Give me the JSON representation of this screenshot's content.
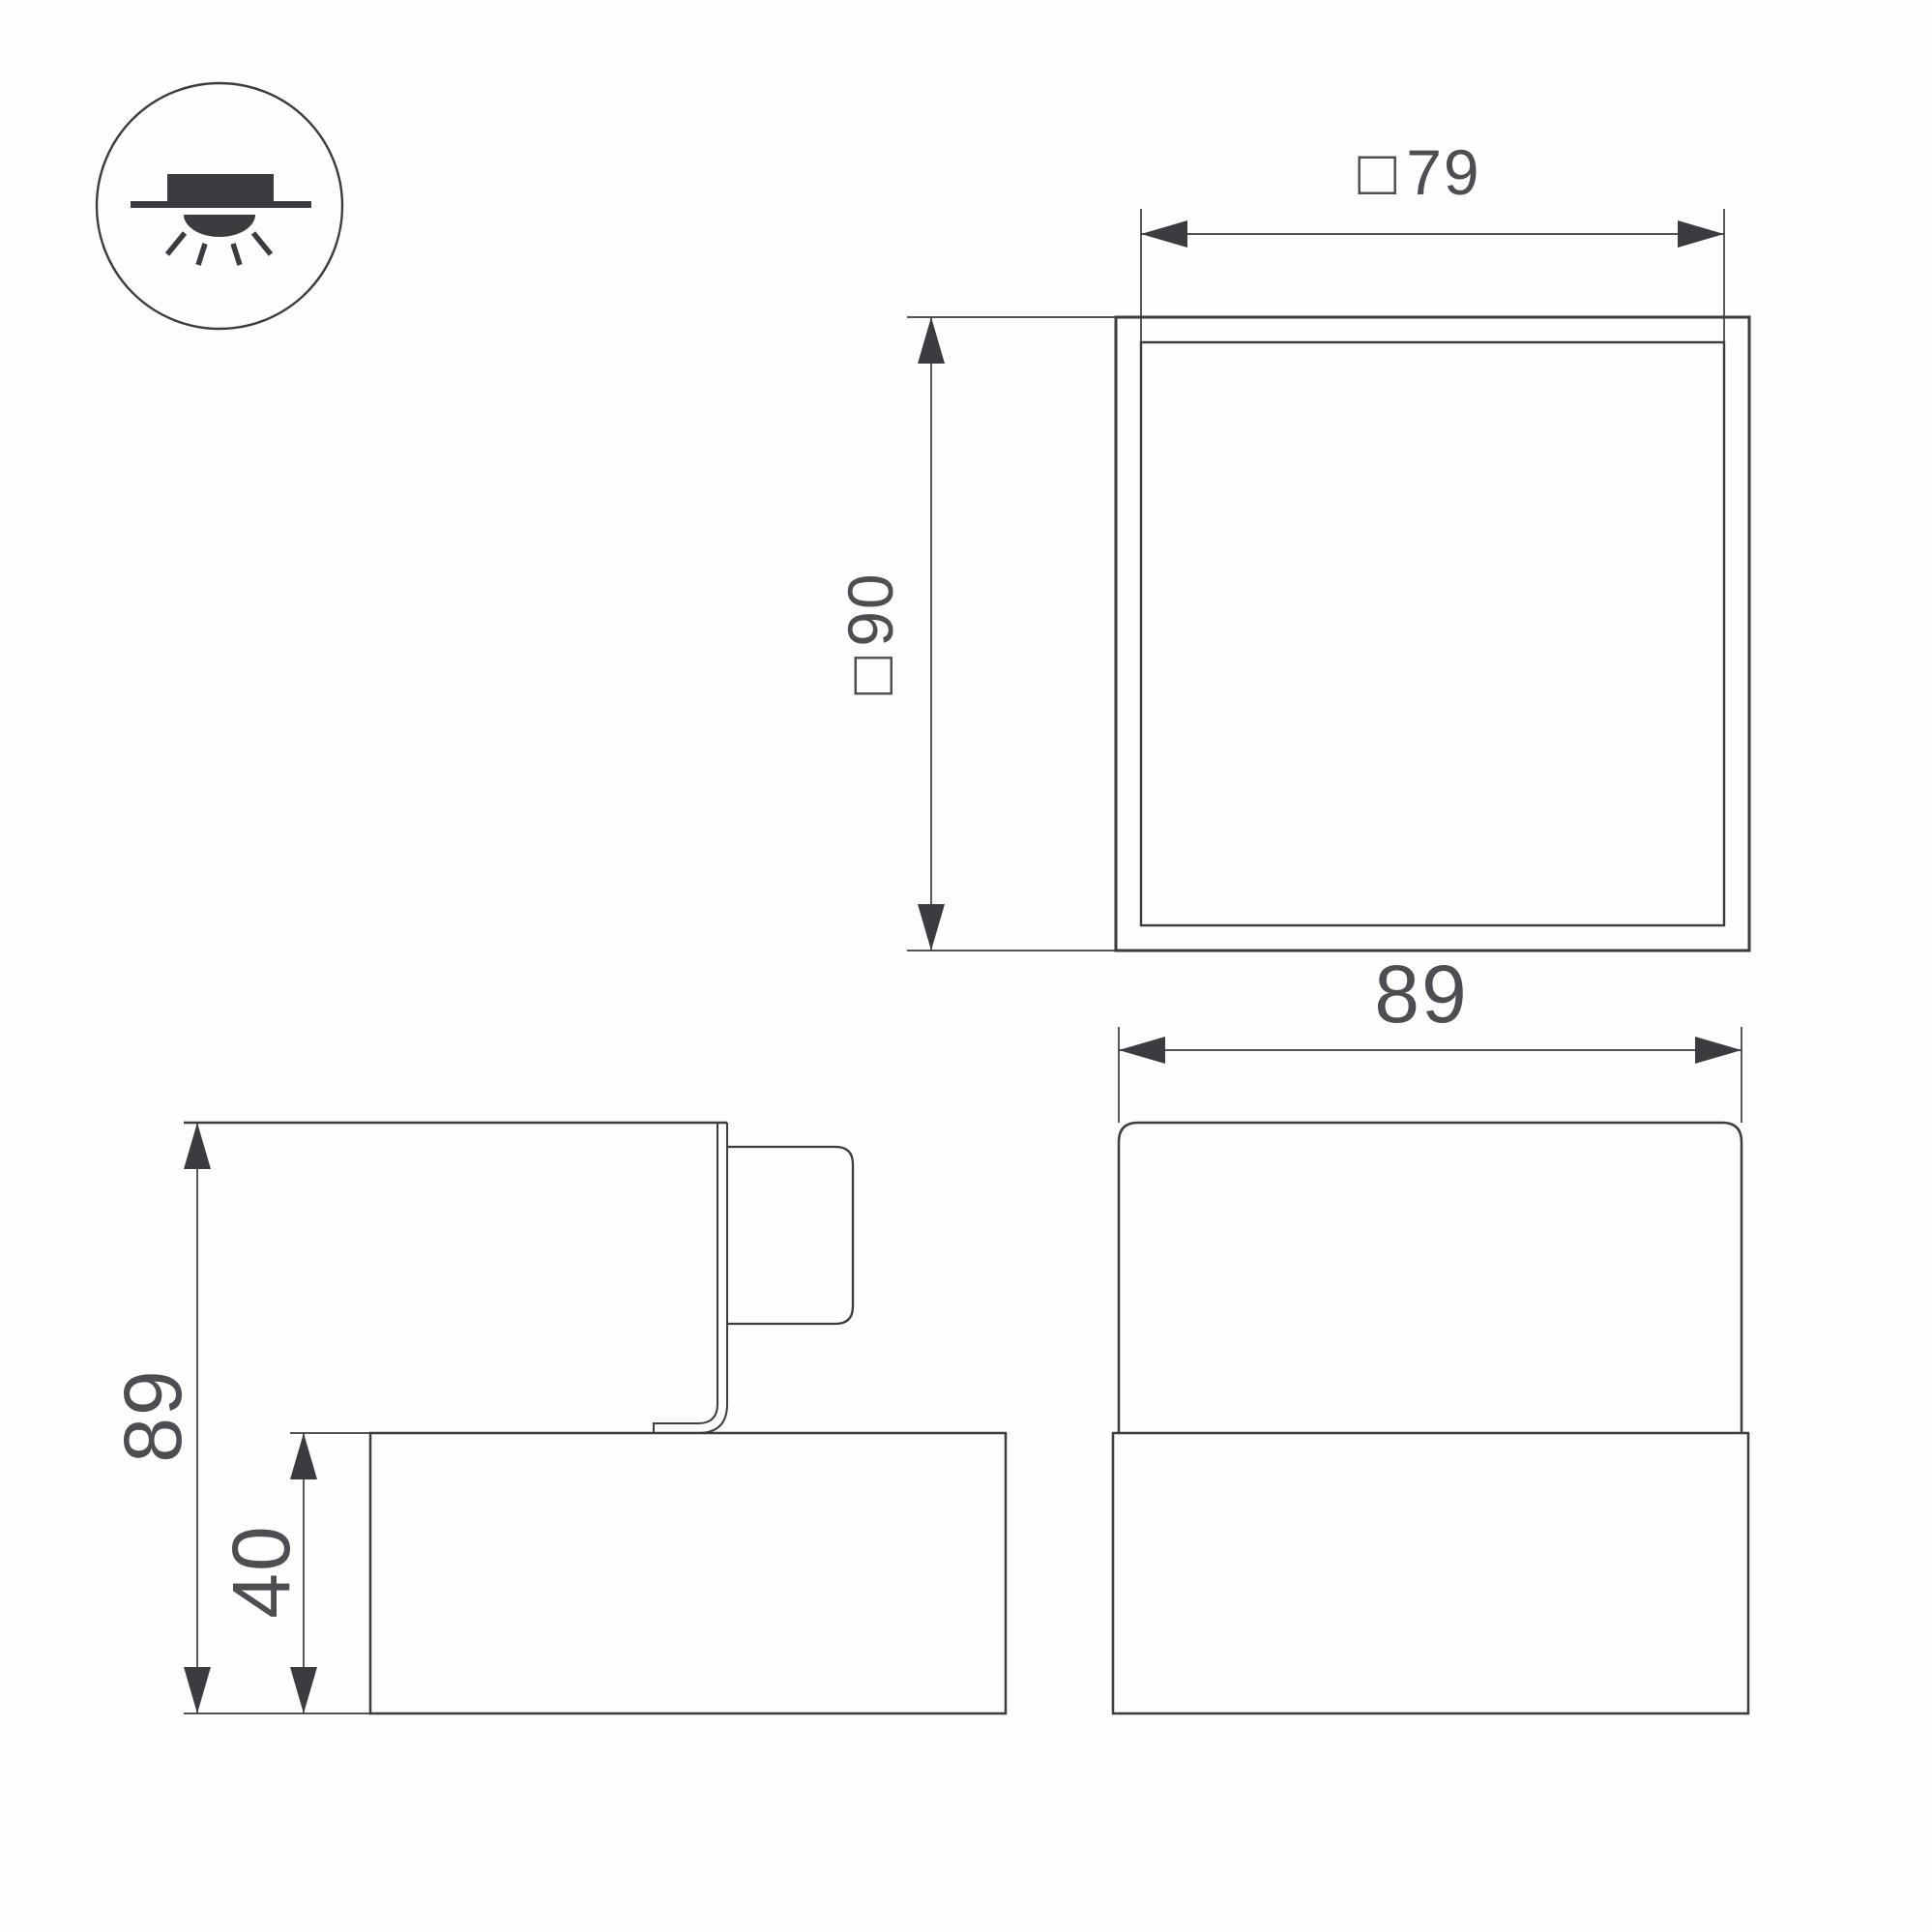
{
  "colors": {
    "line": "#3c3c40",
    "text": "#4d4d52",
    "background": "#fdfdfd"
  },
  "icon": {
    "meaning": "surface-mounted-downlight"
  },
  "dimensions": {
    "top_view_width": {
      "symbol": "□",
      "value": "79"
    },
    "top_view_size": {
      "symbol": "□",
      "value": "90"
    },
    "side_view_total_height": {
      "value": "89"
    },
    "side_view_base_height": {
      "value": "40"
    },
    "front_view_width": {
      "value": "89"
    }
  }
}
